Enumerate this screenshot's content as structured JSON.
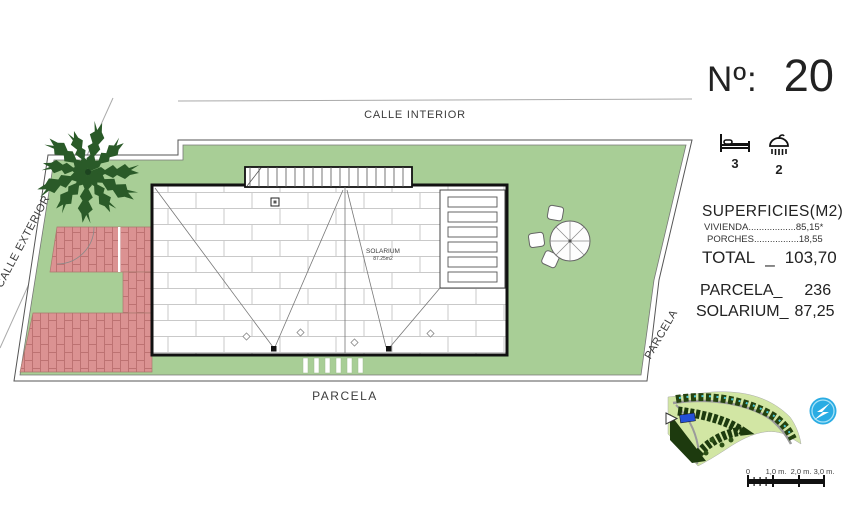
{
  "legend": {
    "number_label": "Nº:",
    "number": "20",
    "bedrooms": "3",
    "bathrooms": "2",
    "surfaces_heading": "SUPERFICIES(M2)",
    "rows": [
      {
        "label": "VIVIENDA",
        "leader": "..................",
        "value": "85,15*"
      },
      {
        "label": "PORCHES",
        "leader": ".................",
        "value": "18,55"
      }
    ],
    "total_label": "TOTAL",
    "total_sep": "_",
    "total_value": "103,70",
    "parcela_label": "PARCELA_",
    "parcela_value": "236",
    "solarium_label": "SOLARIUM_",
    "solarium_value": "87,25"
  },
  "plan": {
    "street_top": "CALLE INTERIOR",
    "street_left": "CALLE EXTERIOR",
    "parcela_bottom": "PARCELA",
    "parcela_right": "PARCELA",
    "solarium_title": "SOLARIUM",
    "solarium_area": "87.25m2"
  },
  "scalebar": {
    "labels": [
      "0",
      "1,0 m.",
      "2,0 m.",
      "3,0 m."
    ]
  },
  "colors": {
    "lawn_green": "#a8ce96",
    "paving_brick": "#db9292",
    "minimap_green": "#d2e6a4",
    "logo_blue": "#2aace3",
    "highlight_lot_blue": "#2450d8"
  }
}
